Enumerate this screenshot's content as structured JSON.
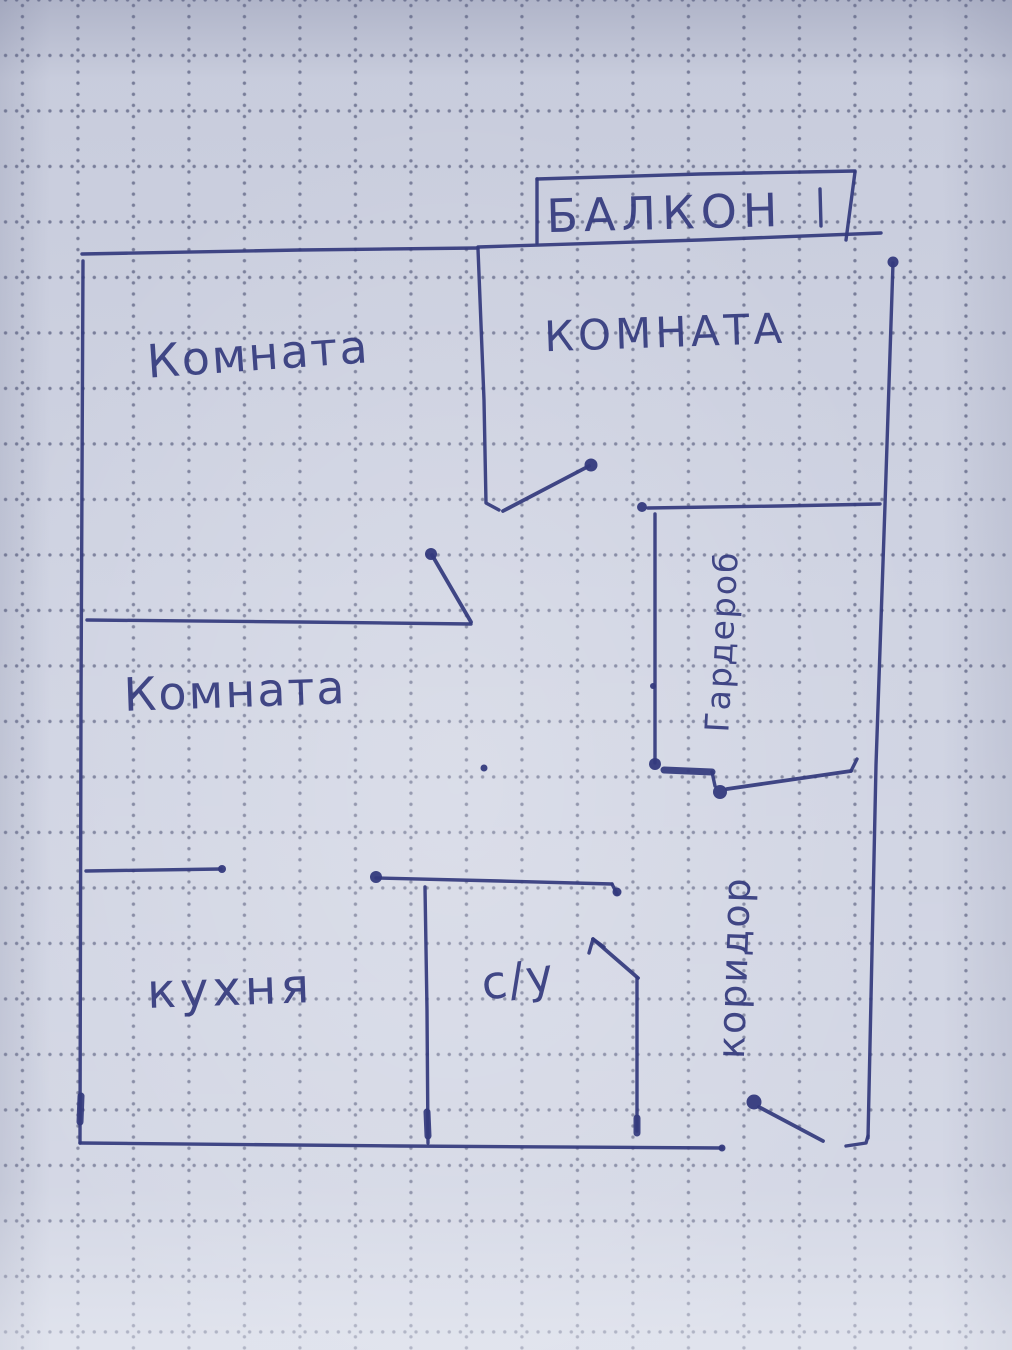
{
  "floor_plan": {
    "ink_color": "#343a7d",
    "paper_color": "#cfd3e2",
    "grid_dot_color": "#3e4468",
    "labels": {
      "balcony": "БАЛКОН",
      "room_top_left": "Комната",
      "room_top_right": "КОМНАТА",
      "room_middle": "Комната",
      "wardrobe": "Гардероб",
      "corridor": "коридор",
      "kitchen": "кухня",
      "bathroom": "с/у"
    }
  }
}
